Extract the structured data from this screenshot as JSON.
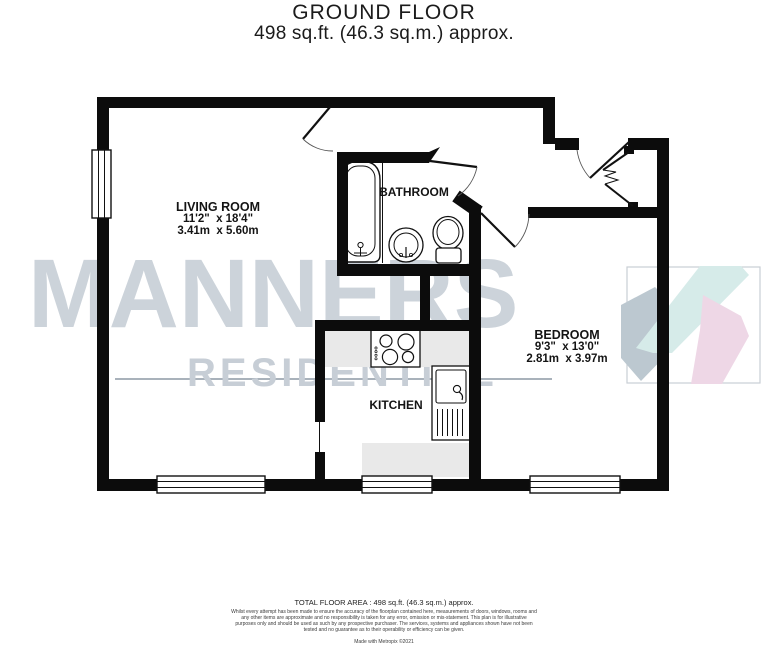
{
  "title": {
    "floor": "GROUND FLOOR",
    "area": "498 sq.ft. (46.3 sq.m.) approx."
  },
  "rooms": {
    "living_room": {
      "name": "LIVING ROOM",
      "imperial": "11'2\"  x 18'4\"",
      "metric": "3.41m  x 5.60m"
    },
    "bathroom": {
      "name": "BATHROOM"
    },
    "bedroom": {
      "name": "BEDROOM",
      "imperial": "9'3\"  x 13'0\"",
      "metric": "2.81m  x 3.97m"
    },
    "kitchen": {
      "name": "KITCHEN"
    }
  },
  "watermark": {
    "line1": "MANNERS",
    "line2": "RESIDENTIAL"
  },
  "footer": {
    "total_area": "TOTAL FLOOR AREA : 498 sq.ft. (46.3 sq.m.) approx.",
    "disclaimer": "Whilst every attempt has been made to ensure the accuracy of the floorplan contained here, measurements of doors, windows, rooms and any other items are approximate and no responsibility is taken for any error, omission or mis-statement. This plan is for illustrative purposes only and should be used as such by any prospective purchaser. The services, systems and appliances shown have not been tested and no guarantee as to their operability or efficiency can be given.",
    "credit": "Made with Metropix ©2021"
  },
  "colors": {
    "wall": "#0c0c0c",
    "counter": "#e9e9e9",
    "watermark_text": "#ccd3da",
    "logo_teal": "#d6ebe9",
    "logo_pink": "#eed7e6",
    "logo_blue_gray": "#bcc8d0"
  }
}
